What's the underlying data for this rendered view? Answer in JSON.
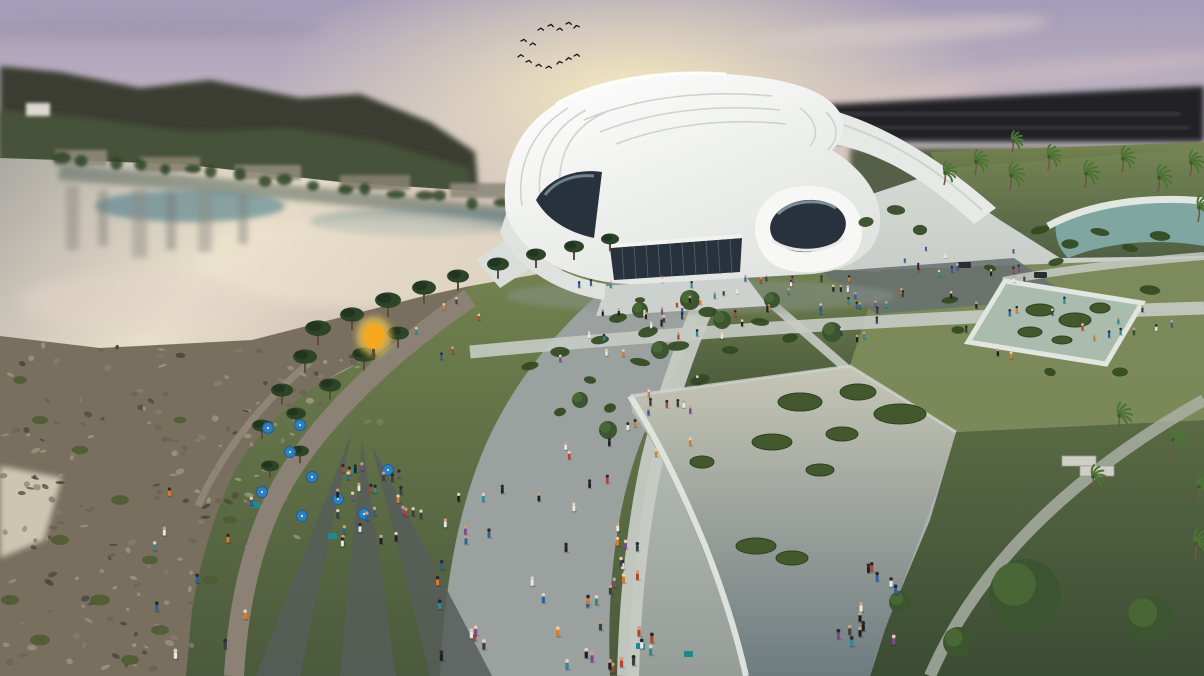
{
  "meta": {
    "type": "architectural-rendering",
    "description": "Aerial dusk rendering of a white curvilinear cultural center beside a river: sunset sky with a flock of birds, reflective river with rocky bank, green park with pines and palms, reflecting pools with grass islands, crowded promenade with blue umbrellas and an orange glowing tree."
  },
  "palette": {
    "sky_top": "#a49cb8",
    "sky_mid": "#c6bac2",
    "sky_low": "#ddd0bd",
    "sun_glow": "#f6eabf",
    "hill": "#3b3e32",
    "hill_green": "#49553a",
    "dark_band": "#232228",
    "water_light": "#e8dfca",
    "water_teal": "#4e7d8a",
    "bank_reflect": "#5c6a5f",
    "bank_rock": "#796f5f",
    "rock_dark": "#4e4a40",
    "rock_light": "#9c937f",
    "sand": "#d7cfbc",
    "lawn_light": "#74834f",
    "lawn_dark": "#4a5a3c",
    "ground_light": "#d8dcd7",
    "ground_mid": "#969d99",
    "path_tan": "#8b8275",
    "path_dark": "#575d59",
    "promenade": "#9aa19e",
    "walk_light": "#c6cbc4",
    "court_dark": "#667070",
    "roof_white": "#f7f8f6",
    "roof_shade": "#e6e9e5",
    "roof_line": "#cfd2ce",
    "glass_dark": "#27323c",
    "glass_light": "#8fa5ad",
    "pool_rim": "#e2e6e0",
    "pool_water_top": "#c6c6b6",
    "pool_water_bottom": "#6e7c80",
    "square_pool": "#a9bcae",
    "curved_pool": "#7fa6a0",
    "island_green": "#44582e",
    "pine": "#2d4426",
    "pine_dark": "#223520",
    "tree_green": "#3c5530",
    "palm_green": "#4c7434",
    "shrub": "#32491f",
    "trunk": "#5d4c39",
    "umbrella_blue": "#2f7fc0",
    "kiosk_teal": "#1f8a8e",
    "orange_tree": "#f5a81f",
    "orange_glow": "#ffd34d",
    "bird": "#15151a",
    "people": [
      "#1d2126",
      "#2e5f9e",
      "#b5432e",
      "#d97b2a",
      "#e8e8e4",
      "#2e8a96",
      "#7a4b8f",
      "#3a3f45"
    ],
    "heads": [
      "#e6cdb2",
      "#caa07e",
      "#2a2a2e"
    ]
  },
  "scene": {
    "birds": [
      [
        538,
        30
      ],
      [
        548,
        26
      ],
      [
        557,
        30
      ],
      [
        566,
        24
      ],
      [
        574,
        28
      ],
      [
        521,
        41
      ],
      [
        530,
        45
      ],
      [
        518,
        57
      ],
      [
        526,
        62
      ],
      [
        536,
        66
      ],
      [
        546,
        68
      ],
      [
        557,
        64
      ],
      [
        566,
        60
      ],
      [
        574,
        56
      ]
    ],
    "far_bank_trees": {
      "from": [
        60,
        158
      ],
      "to": [
        650,
        220
      ],
      "count": 24
    },
    "people_clusters": [
      {
        "name": "plaza-front",
        "x": 560,
        "y": 280,
        "w": 320,
        "h": 45,
        "count": 36
      },
      {
        "name": "plaza-right",
        "x": 880,
        "y": 245,
        "w": 200,
        "h": 55,
        "count": 16
      },
      {
        "name": "walkway-long",
        "x": 600,
        "y": 302,
        "w": 600,
        "h": 44,
        "count": 22
      },
      {
        "name": "square-pool-edge",
        "x": 950,
        "y": 290,
        "w": 210,
        "h": 85,
        "count": 10
      },
      {
        "name": "promenade-mid",
        "x": 560,
        "y": 330,
        "w": 140,
        "h": 140,
        "count": 22
      },
      {
        "name": "promenade-low",
        "x": 432,
        "y": 470,
        "w": 225,
        "h": 206,
        "count": 40
      },
      {
        "name": "crowd",
        "x": 335,
        "y": 470,
        "w": 95,
        "h": 78,
        "count": 28
      },
      {
        "name": "lawn-kids",
        "x": 835,
        "y": 565,
        "w": 70,
        "h": 100,
        "count": 13
      },
      {
        "name": "left-path",
        "x": 150,
        "y": 480,
        "w": 105,
        "h": 196,
        "count": 10
      },
      {
        "name": "bank-walk",
        "x": 390,
        "y": 300,
        "w": 90,
        "h": 60,
        "count": 6
      },
      {
        "name": "pool-rim-walk",
        "x": 600,
        "y": 560,
        "w": 58,
        "h": 116,
        "count": 8
      }
    ],
    "pines": [
      [
        318,
        334,
        13
      ],
      [
        352,
        320,
        12
      ],
      [
        388,
        306,
        13
      ],
      [
        424,
        293,
        12
      ],
      [
        458,
        281,
        11
      ],
      [
        498,
        269,
        11
      ],
      [
        536,
        259,
        10
      ],
      [
        574,
        251,
        10
      ],
      [
        610,
        243,
        9
      ],
      [
        305,
        362,
        12
      ],
      [
        282,
        395,
        11
      ],
      [
        262,
        430,
        10
      ],
      [
        296,
        418,
        10
      ],
      [
        330,
        390,
        11
      ],
      [
        364,
        360,
        12
      ],
      [
        398,
        338,
        11
      ],
      [
        300,
        455,
        9
      ],
      [
        270,
        470,
        9
      ]
    ],
    "round_trees": [
      [
        690,
        300,
        10
      ],
      [
        722,
        320,
        9
      ],
      [
        660,
        350,
        9
      ],
      [
        640,
        310,
        8
      ],
      [
        832,
        332,
        10
      ],
      [
        772,
        300,
        8
      ],
      [
        1025,
        595,
        36
      ],
      [
        1150,
        620,
        24
      ],
      [
        958,
        642,
        15
      ],
      [
        900,
        602,
        11
      ],
      [
        608,
        430,
        9
      ],
      [
        580,
        400,
        8
      ]
    ],
    "palms": [
      [
        975,
        175,
        12
      ],
      [
        1010,
        190,
        13
      ],
      [
        1048,
        170,
        12
      ],
      [
        1085,
        188,
        13
      ],
      [
        1122,
        172,
        12
      ],
      [
        1158,
        192,
        13
      ],
      [
        1190,
        176,
        12
      ],
      [
        1198,
        222,
        13
      ],
      [
        1012,
        152,
        10
      ],
      [
        944,
        185,
        11
      ],
      [
        1118,
        430,
        13
      ],
      [
        1172,
        455,
        14
      ],
      [
        1198,
        502,
        14
      ],
      [
        1092,
        490,
        12
      ],
      [
        1195,
        560,
        15
      ]
    ],
    "shrubs": [
      [
        618,
        318,
        9
      ],
      [
        648,
        332,
        8
      ],
      [
        678,
        346,
        9
      ],
      [
        708,
        312,
        8
      ],
      [
        640,
        362,
        8
      ],
      [
        600,
        340,
        7
      ],
      [
        560,
        352,
        8
      ],
      [
        530,
        366,
        8
      ],
      [
        700,
        380,
        8
      ],
      [
        730,
        350,
        7
      ],
      [
        760,
        322,
        8
      ],
      [
        790,
        338,
        8
      ],
      [
        640,
        300,
        6
      ],
      [
        590,
        380,
        7
      ],
      [
        560,
        412,
        7
      ],
      [
        610,
        408,
        7
      ],
      [
        950,
        300,
        7
      ],
      [
        958,
        330,
        7
      ],
      [
        1150,
        290,
        8
      ],
      [
        1120,
        372,
        8
      ],
      [
        1050,
        372,
        7
      ],
      [
        990,
        268,
        7
      ],
      [
        1040,
        230,
        8
      ],
      [
        1070,
        244,
        8
      ],
      [
        1100,
        232,
        8
      ],
      [
        1130,
        248,
        8
      ],
      [
        1160,
        236,
        8
      ],
      [
        1056,
        262,
        7
      ],
      [
        866,
        222,
        8
      ],
      [
        896,
        210,
        8
      ],
      [
        920,
        230,
        8
      ]
    ],
    "grass_tufts": [
      [
        40,
        420,
        8
      ],
      [
        80,
        450,
        8
      ],
      [
        120,
        500,
        9
      ],
      [
        60,
        540,
        9
      ],
      [
        150,
        560,
        8
      ],
      [
        100,
        600,
        10
      ],
      [
        40,
        640,
        10
      ],
      [
        160,
        630,
        9
      ],
      [
        210,
        580,
        8
      ],
      [
        230,
        520,
        7
      ],
      [
        20,
        380,
        7
      ],
      [
        180,
        420,
        6
      ],
      [
        10,
        600,
        9
      ],
      [
        130,
        660,
        9
      ]
    ],
    "rock_patches": [
      {
        "x": 0,
        "y": 345,
        "w": 320,
        "h": 110,
        "count": 55
      },
      {
        "x": 150,
        "y": 430,
        "w": 150,
        "h": 120,
        "count": 38
      },
      {
        "x": 80,
        "y": 540,
        "w": 130,
        "h": 130,
        "count": 36
      },
      {
        "x": 0,
        "y": 430,
        "w": 95,
        "h": 240,
        "count": 46
      },
      {
        "x": 230,
        "y": 355,
        "w": 170,
        "h": 70,
        "count": 26
      }
    ],
    "pool_islands": {
      "large": [
        [
          800,
          402,
          22,
          9
        ],
        [
          858,
          392,
          18,
          8
        ],
        [
          900,
          414,
          26,
          10
        ],
        [
          842,
          434,
          16,
          7
        ],
        [
          772,
          442,
          20,
          8
        ],
        [
          820,
          470,
          14,
          6
        ],
        [
          756,
          546,
          20,
          8
        ],
        [
          792,
          558,
          16,
          7
        ],
        [
          702,
          462,
          12,
          6
        ]
      ],
      "square": [
        [
          1040,
          310,
          14,
          6
        ],
        [
          1075,
          320,
          16,
          7
        ],
        [
          1100,
          308,
          10,
          5
        ],
        [
          1030,
          332,
          12,
          5
        ],
        [
          1062,
          340,
          10,
          4
        ]
      ]
    },
    "umbrellas": [
      [
        268,
        428
      ],
      [
        290,
        452
      ],
      [
        312,
        477
      ],
      [
        338,
        499
      ],
      [
        364,
        514
      ],
      [
        302,
        516
      ],
      [
        262,
        492
      ],
      [
        388,
        470
      ],
      [
        300,
        425
      ]
    ],
    "kiosks": [
      [
        255,
        505
      ],
      [
        332,
        536
      ],
      [
        640,
        646
      ],
      [
        688,
        654
      ],
      [
        352,
        470
      ]
    ],
    "orange_tree": {
      "x": 374,
      "y": 336
    },
    "cars": [
      [
        958,
        262
      ],
      [
        1034,
        272
      ]
    ],
    "benches": [
      [
        1062,
        456,
        34,
        10
      ],
      [
        1080,
        466,
        34,
        10
      ]
    ]
  }
}
